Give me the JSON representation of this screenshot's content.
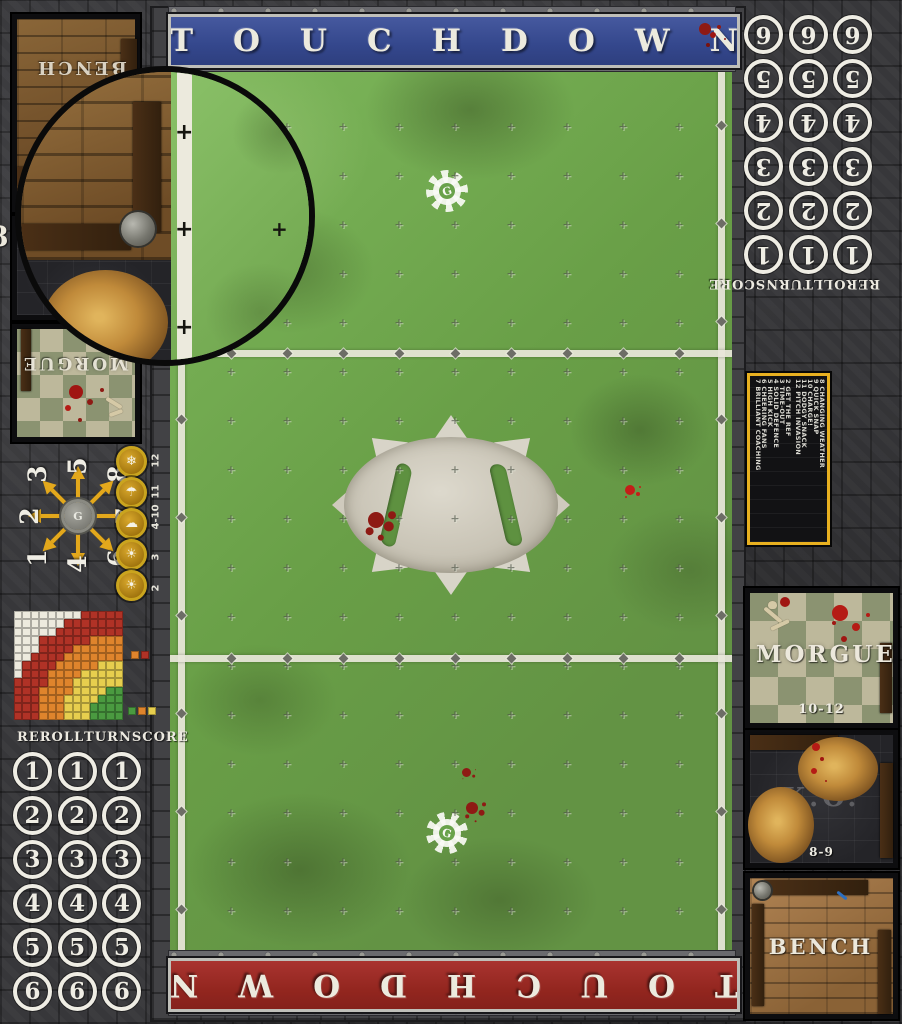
{
  "banners": {
    "top_label": "TOUCHDOWN",
    "bottom_label": "TOUCHDOWN"
  },
  "score_track": {
    "headers": [
      "REROLL",
      "TURN",
      "SCORE"
    ],
    "bottom_left_rows": [
      "1",
      "2",
      "3",
      "4",
      "5",
      "6"
    ],
    "top_right_rows": [
      "6",
      "5",
      "4",
      "3",
      "2",
      "1"
    ],
    "columns_per_row": 3
  },
  "turn_dial": {
    "numbers": [
      "1",
      "2",
      "3",
      "4",
      "5",
      "6",
      "7",
      "8"
    ]
  },
  "weather_track": {
    "items": [
      {
        "range": "12",
        "icon": "snow-cloud-icon"
      },
      {
        "range": "11",
        "icon": "rain-cloud-icon"
      },
      {
        "range": "4-10",
        "icon": "sun-cloud-icon"
      },
      {
        "range": "3",
        "icon": "sun-icon"
      },
      {
        "range": "2",
        "icon": "sun-icon"
      }
    ]
  },
  "pass_range_chart": {
    "rows": [
      "WWWWWWWWRRRRR",
      "WWWWWWRRRRRRR",
      "WWWWWRRRRRRRR",
      "WWWRRRRRROOOO",
      "WWWRRRROOOOOO",
      "WWRRRROOOOOOO",
      "WRRRROOOOOYYY",
      "WRRROOOOYYYYY",
      "RRRROOOYYYYYY",
      "RRROOOOYYYYGG",
      "RRROOOYYYYGGG",
      "RRROOOYYYGGGG",
      "RRROOOYYYGGGG"
    ],
    "palette": {
      "W": "#edeade",
      "R": "#b03226",
      "O": "#df842c",
      "Y": "#e7ce4e",
      "G": "#4a9a40"
    },
    "legend_top": [
      "O",
      "R"
    ],
    "legend_bottom": [
      "G",
      "O",
      "Y"
    ]
  },
  "kickoff_table": {
    "col_a": [
      "2 GET THE REF",
      "3 TIME-OUT",
      "4 SOLID DEFENCE",
      "5 HIGH KICK",
      "6 CHEERING FANS",
      "7 BRILLIANT COACHING"
    ],
    "col_b": [
      "8 CHANGING WEATHER",
      "9 QUICK SNAP",
      "10 CHARGE!",
      "11 DODGY SNACK",
      "12 PITCH INVASION"
    ],
    "border_color": "#e8b020"
  },
  "dugouts": {
    "top_left": {
      "bench_label": "BENCH",
      "morgue_label": "MORGUE",
      "ko_edge_label": "8"
    },
    "bottom_right": {
      "morgue_label": "MORGUE",
      "morgue_range": "10-12",
      "ko_label": "K.O.",
      "ko_range": "8-9",
      "bench_label": "BENCH"
    }
  },
  "colors": {
    "banner_blue": "#3b4e96",
    "banner_red": "#9e2a25",
    "pitch_green": "#6fae4e",
    "gold": "#e3a81c",
    "stone_dark": "#38383a",
    "blood_dark": "#8e1a14",
    "blood_bright": "#c41e18"
  }
}
